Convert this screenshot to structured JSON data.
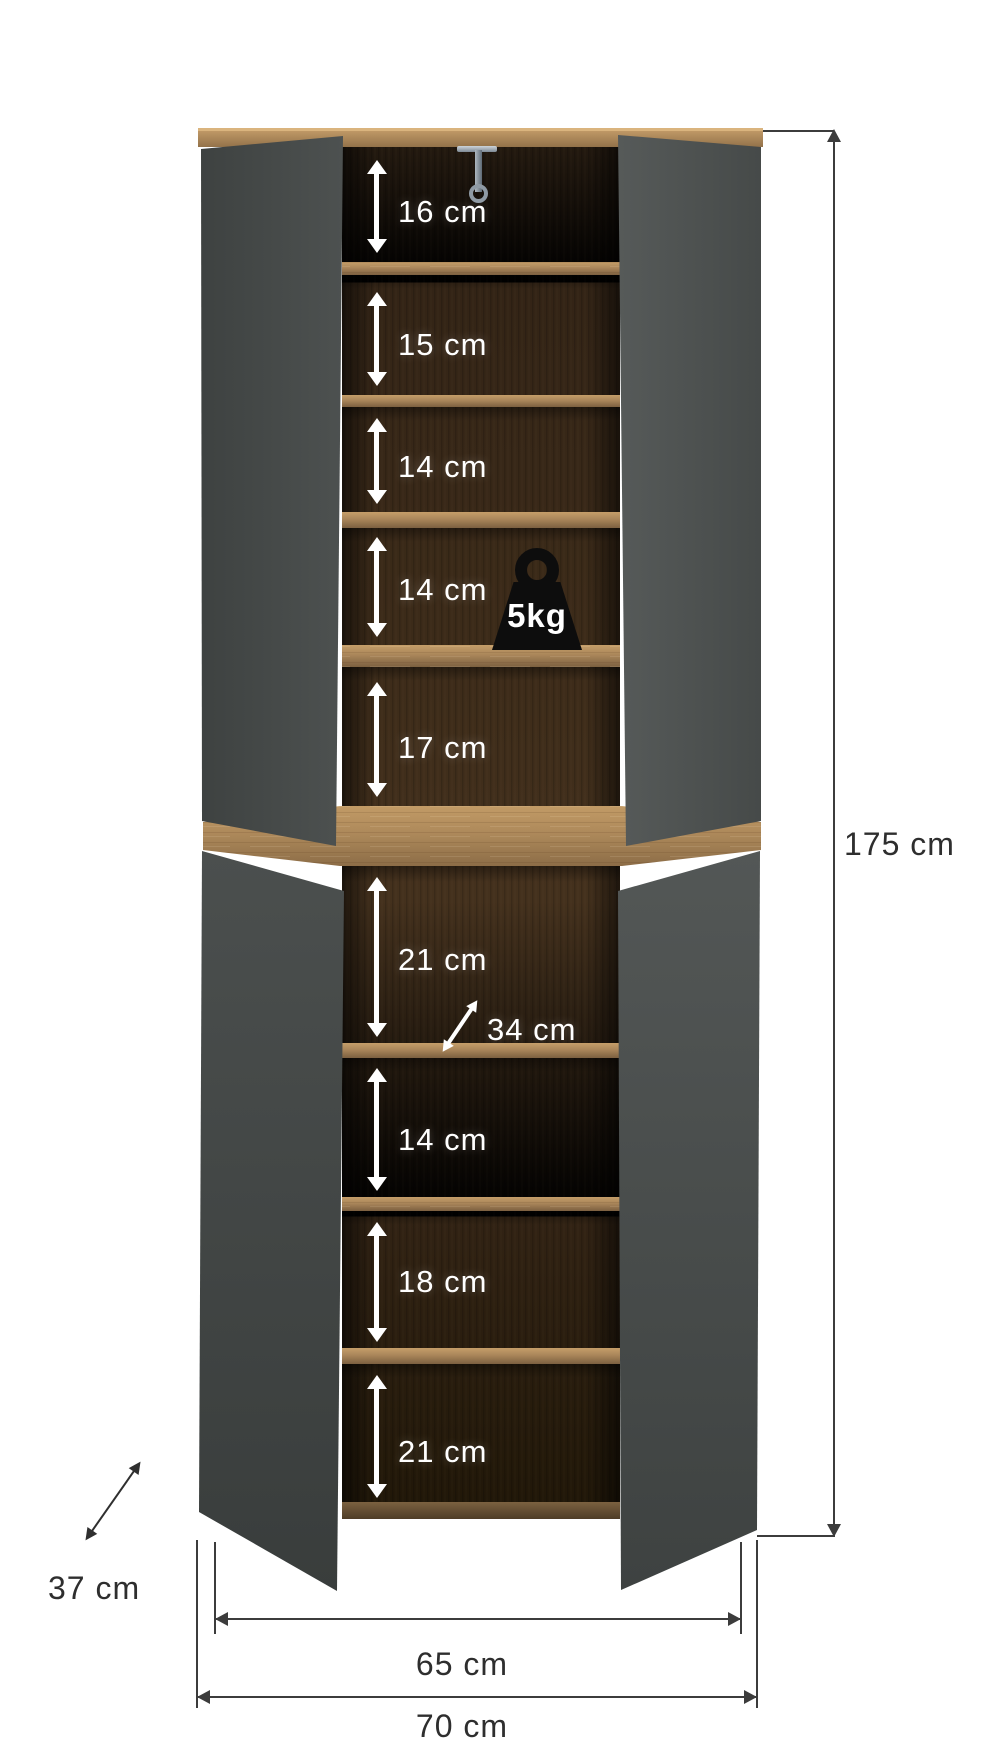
{
  "measurements": {
    "compartments": [
      "16 cm",
      "15 cm",
      "14 cm",
      "14 cm",
      "17 cm",
      "21 cm",
      "14 cm",
      "18 cm",
      "21 cm"
    ],
    "shelf_depth": "34 cm",
    "total_height": "175 cm",
    "depth": "37 cm",
    "inner_width": "65 cm",
    "outer_width": "70 cm"
  },
  "badges": {
    "max_shelf_load": "5kg"
  },
  "icons": {
    "key": "key-icon",
    "weight": "weight-icon"
  },
  "colors": {
    "background": "#ffffff",
    "door_gray": "#4a4e4d",
    "interior_wood_dark": "#36261a",
    "shelf_oak": "#b08c5c",
    "annotation_line": "#3c3c3c",
    "annotation_text_dark": "#2e2e2e",
    "annotation_text_light": "#ffffff",
    "weight_icon": "#0d0d0d"
  }
}
